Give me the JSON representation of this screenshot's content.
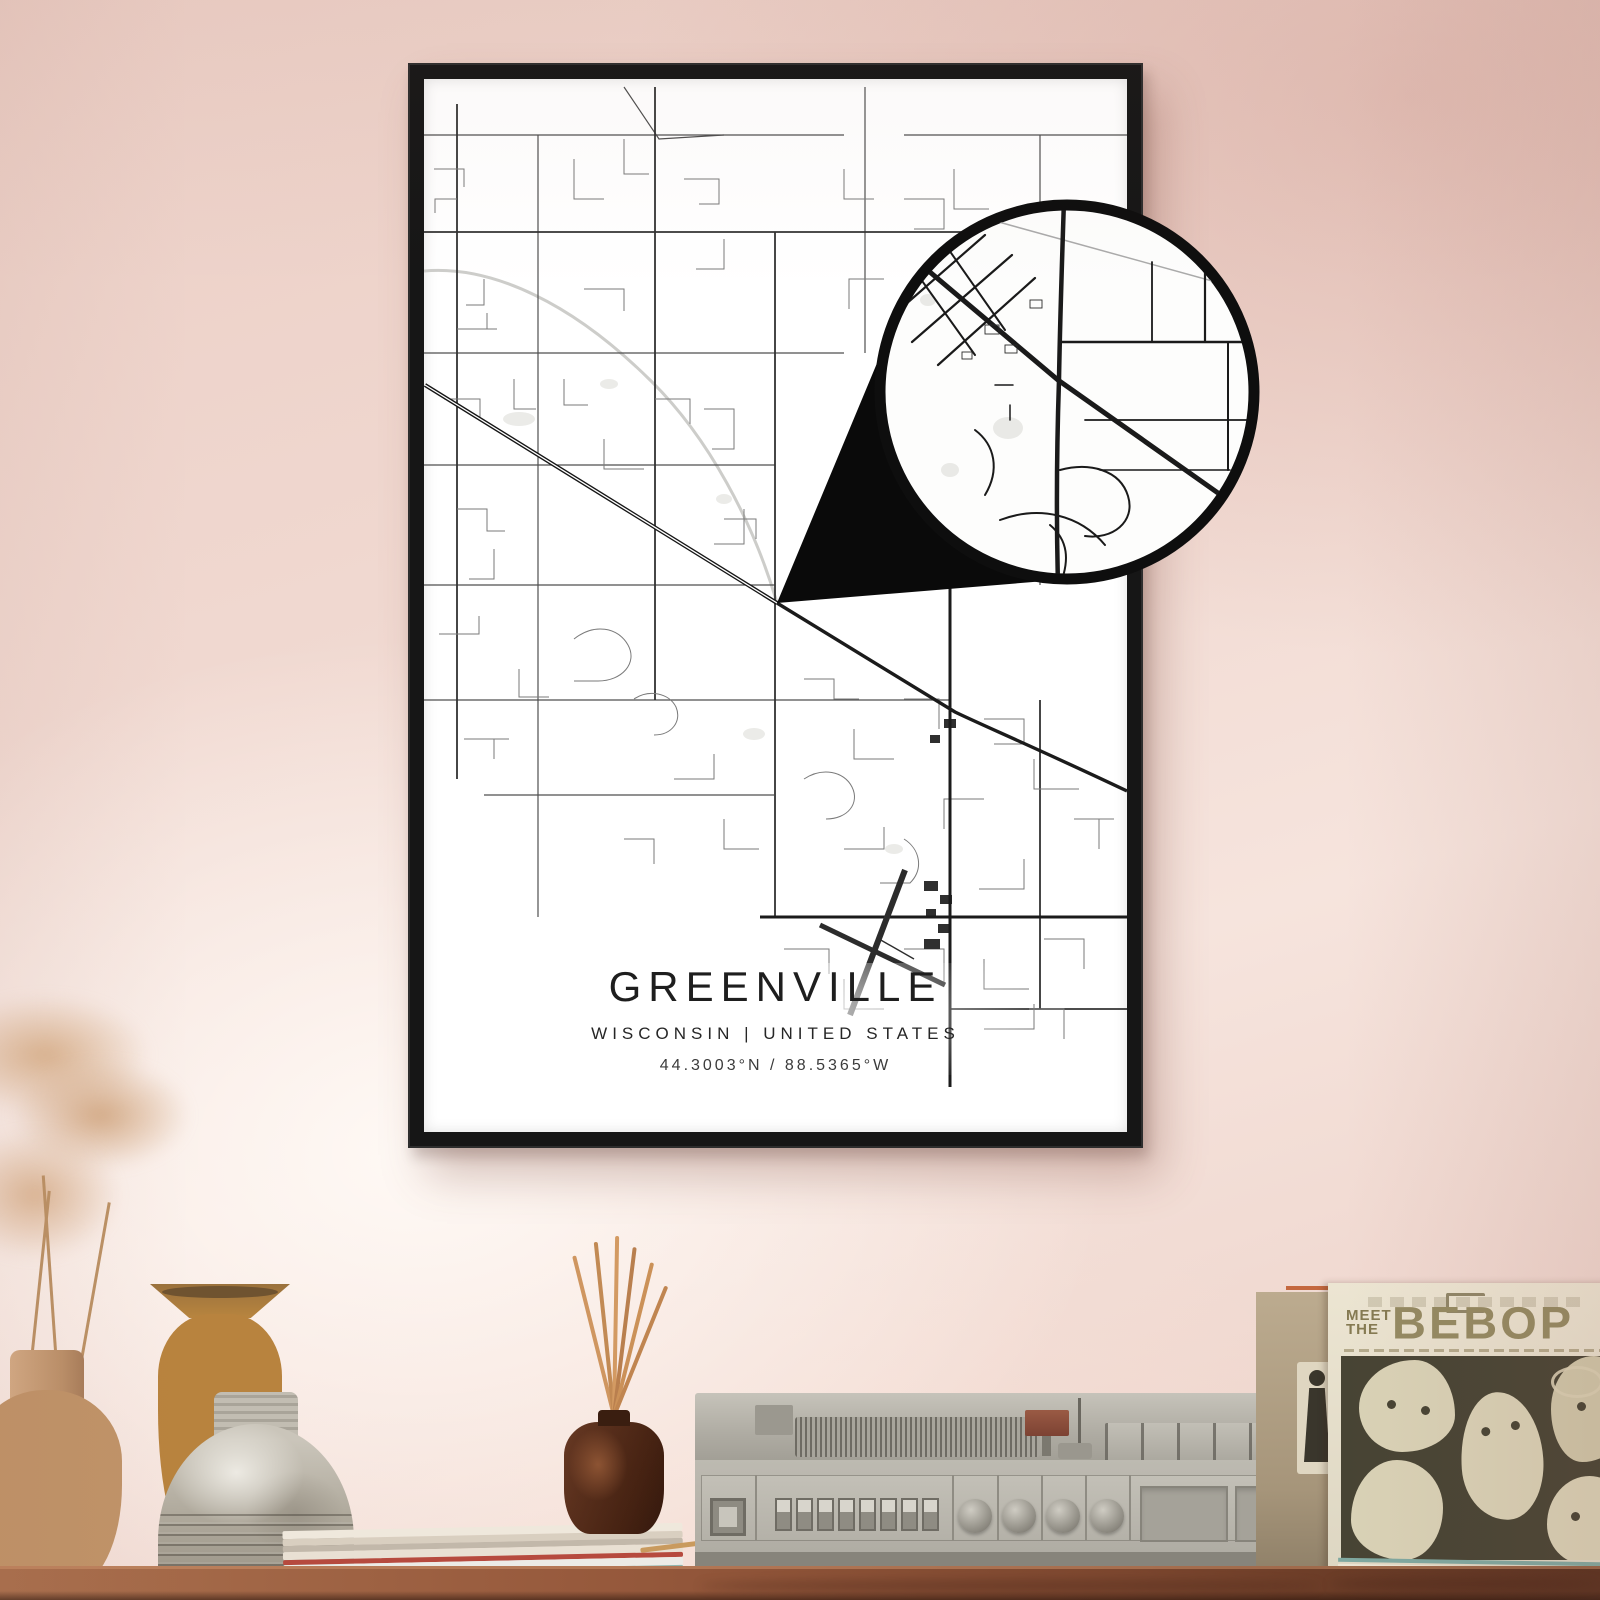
{
  "poster": {
    "title": "GREENVILLE",
    "subtitle": "WISCONSIN | UNITED STATES",
    "coordinates": "44.3003°N / 88.5365°W"
  },
  "record_sleeve": {
    "meet_the": "MEET\nTHE",
    "title": "BEBOP"
  },
  "colors": {
    "wall_pink": "#efd6ce",
    "frame_black": "#161616",
    "map_paper": "#ffffff",
    "road_dark": "#1d1d1d",
    "table_wood": "#8a5138",
    "sleeve_cream": "#e6dfcc",
    "sleeve_art_olive": "#474434",
    "sleeve_title_olive": "#948a62",
    "reed_stick": "#c98d58",
    "diffuser_brown": "#45281a",
    "player_gray": "#b5b2a9",
    "accent_red": "#b03226"
  }
}
